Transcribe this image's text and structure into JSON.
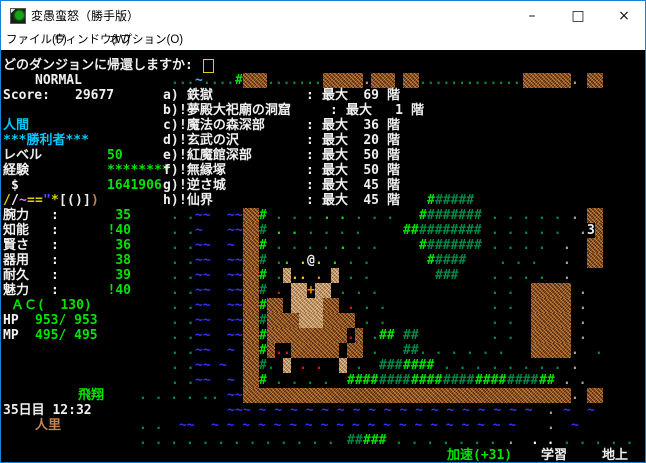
{
  "window": {
    "title": "変愚蛮怒（勝手版）",
    "controls": {
      "minimize": "–",
      "maximize": "□",
      "close": "×"
    },
    "border_color": "#1581d7"
  },
  "menu": {
    "items": [
      "ファイル(F)",
      "ウィンドウ(W)",
      "オプション(O)"
    ]
  },
  "palette": {
    "W": "#f0f0f0",
    "w": "#a0a0a0",
    "C": "#00c8ff",
    "G": "#00e400",
    "g": "#008845",
    "Y": "#ddd000",
    "O": "#ff8c00",
    "R": "#e01010",
    "B": "#3333f5",
    "L": "#3fb3f5",
    "M": "#f070f0",
    "U": "#c8824b",
    "b": "#5050ff"
  },
  "game": {
    "prompt": {
      "text": "どのダンジョンに帰還しますか:"
    },
    "mode": "NORMAL",
    "score_label": "Score:",
    "score": "29677"
  },
  "player": {
    "race": "人間",
    "title_str": "***勝利者***",
    "level_label": "レベル",
    "level": "50",
    "exp_label": "経験",
    "exp": "********",
    "gold_symbol": "$",
    "gold": "1641906",
    "equip": [
      [
        "/",
        "Y"
      ],
      [
        "/",
        "W"
      ],
      [
        "~",
        "M"
      ],
      [
        "=",
        "Y"
      ],
      [
        "=",
        "Y"
      ],
      [
        "\"",
        "b"
      ],
      [
        "*",
        "Y"
      ],
      [
        "[",
        "W"
      ],
      [
        "(",
        "W"
      ],
      [
        ")",
        "W"
      ],
      [
        "]",
        "W"
      ],
      [
        ")",
        "U"
      ]
    ],
    "stats": [
      {
        "label": "腕力",
        "value": "35"
      },
      {
        "label": "知能",
        "value": "!40"
      },
      {
        "label": "賢さ",
        "value": "36"
      },
      {
        "label": "器用",
        "value": "38"
      },
      {
        "label": "耐久",
        "value": "39"
      },
      {
        "label": "魅力",
        "value": "!40"
      }
    ],
    "ac": "ＡＣ(  130)",
    "hp_label": "HP",
    "hp": "953/ 953",
    "mp_label": "MP",
    "mp": "495/ 495",
    "flight": "飛翔",
    "datetime": "35日目 12:32",
    "location": "人里"
  },
  "dungeons": {
    "items": [
      {
        "key": "a)",
        "name": " 鉄獄",
        "max_label": "最大",
        "value": "69",
        "unit": "階",
        "wide": false
      },
      {
        "key": "b)",
        "name": "!夢殿大祀廟の洞窟",
        "max_label": "最大",
        "value": "1",
        "unit": "階",
        "wide": true
      },
      {
        "key": "c)",
        "name": "!魔法の森深部",
        "max_label": "最大",
        "value": "36",
        "unit": "階",
        "wide": false
      },
      {
        "key": "d)",
        "name": "!玄武の沢",
        "max_label": "最大",
        "value": "20",
        "unit": "階",
        "wide": false
      },
      {
        "key": "e)",
        "name": "!紅魔館深部",
        "max_label": "最大",
        "value": "50",
        "unit": "階",
        "wide": false
      },
      {
        "key": "f)",
        "name": "!無縁塚",
        "max_label": "最大",
        "value": "50",
        "unit": "階",
        "wide": false
      },
      {
        "key": "g)",
        "name": "!逆さ城",
        "max_label": "最大",
        "value": "45",
        "unit": "階",
        "wide": false
      },
      {
        "key": "h)",
        "name": "!仙界",
        "max_label": "最大",
        "value": "45",
        "unit": "階",
        "wide": false
      }
    ]
  },
  "statusbar": {
    "speed": "加速(+31)",
    "learning": "学習",
    "floor": "地上"
  },
  "map": {
    "segs": [
      [
        1,
        21,
        "...",
        "g"
      ],
      [
        1,
        24,
        "~",
        "L"
      ],
      [
        1,
        25,
        "....",
        "g"
      ],
      [
        1,
        29,
        "#",
        "G"
      ],
      [
        1,
        33,
        ".......",
        "g"
      ],
      [
        1,
        45,
        ".",
        "w"
      ],
      [
        1,
        52,
        ".............",
        "g"
      ],
      [
        1,
        71,
        ". ",
        "w"
      ],
      [
        9,
        53,
        "#",
        "G"
      ],
      [
        9,
        54,
        "#####",
        "g"
      ],
      [
        10,
        21,
        ". .",
        "g"
      ],
      [
        10,
        24,
        "~~",
        "B"
      ],
      [
        10,
        28,
        "~~",
        "B"
      ],
      [
        10,
        32,
        "#",
        "G"
      ],
      [
        10,
        34,
        ". . .",
        "g"
      ],
      [
        10,
        40,
        ". .",
        "G"
      ],
      [
        10,
        44,
        ". . . ",
        "g"
      ],
      [
        10,
        52,
        "#",
        "G"
      ],
      [
        10,
        53,
        "#######",
        "g"
      ],
      [
        10,
        61,
        ". . . . .",
        "g"
      ],
      [
        10,
        71,
        ".",
        "w"
      ],
      [
        11,
        21,
        ". .",
        "g"
      ],
      [
        11,
        24,
        "~",
        "B"
      ],
      [
        11,
        28,
        "~~",
        "B"
      ],
      [
        11,
        32,
        "#",
        "g"
      ],
      [
        11,
        34,
        ". .",
        "G"
      ],
      [
        11,
        38,
        ". . . .",
        "g"
      ],
      [
        11,
        50,
        "##",
        "G"
      ],
      [
        11,
        52,
        "########",
        "g"
      ],
      [
        11,
        61,
        ". . . . .",
        "g"
      ],
      [
        11,
        72,
        ".",
        "w"
      ],
      [
        11,
        73,
        "3",
        "W"
      ],
      [
        12,
        21,
        ". .",
        "g"
      ],
      [
        12,
        24,
        "~~",
        "B"
      ],
      [
        12,
        28,
        "~",
        "B"
      ],
      [
        12,
        32,
        "#",
        "G"
      ],
      [
        12,
        34,
        ". . . .",
        "g"
      ],
      [
        12,
        42,
        ".",
        "G"
      ],
      [
        12,
        44,
        ". .",
        "g"
      ],
      [
        12,
        52,
        "#",
        "G"
      ],
      [
        12,
        53,
        "#######",
        "g"
      ],
      [
        12,
        61,
        ". . . .",
        "g"
      ],
      [
        12,
        70,
        ". ",
        "w"
      ],
      [
        13,
        21,
        ". .",
        "g"
      ],
      [
        13,
        24,
        "~~",
        "B"
      ],
      [
        13,
        28,
        "~~",
        "B"
      ],
      [
        13,
        32,
        "#",
        "g"
      ],
      [
        13,
        34,
        ".",
        "g"
      ],
      [
        13,
        35,
        ".",
        "G"
      ],
      [
        13,
        37,
        ".",
        "Y"
      ],
      [
        13,
        38,
        "@",
        "W"
      ],
      [
        13,
        39,
        ".",
        "Y"
      ],
      [
        13,
        41,
        ".",
        "G"
      ],
      [
        13,
        43,
        ". .",
        "g"
      ],
      [
        13,
        53,
        "#",
        "G"
      ],
      [
        13,
        54,
        "####",
        "g"
      ],
      [
        13,
        62,
        ". . .",
        "g"
      ],
      [
        13,
        70,
        ".",
        "w"
      ],
      [
        14,
        21,
        ". .",
        "g"
      ],
      [
        14,
        24,
        "~~",
        "B"
      ],
      [
        14,
        28,
        "~~",
        "B"
      ],
      [
        14,
        32,
        "#",
        "G"
      ],
      [
        14,
        34,
        ".",
        "g"
      ],
      [
        14,
        36,
        ".",
        "Y"
      ],
      [
        14,
        37,
        ".",
        "Y"
      ],
      [
        14,
        39,
        ".",
        "O"
      ],
      [
        14,
        43,
        ". .",
        "g"
      ],
      [
        14,
        54,
        "###",
        "g"
      ],
      [
        14,
        61,
        ". . . .",
        "g"
      ],
      [
        14,
        70,
        ". ",
        "w"
      ],
      [
        15,
        21,
        ". .",
        "g"
      ],
      [
        15,
        24,
        "~~",
        "B"
      ],
      [
        15,
        28,
        "~~",
        "B"
      ],
      [
        15,
        32,
        "#",
        "g"
      ],
      [
        15,
        34,
        ".",
        "R"
      ],
      [
        15,
        38,
        "+",
        "O"
      ],
      [
        15,
        42,
        ".",
        "g"
      ],
      [
        15,
        44,
        ". .",
        "g"
      ],
      [
        15,
        61,
        ". .",
        "g"
      ],
      [
        15,
        72,
        ".",
        "w"
      ],
      [
        16,
        21,
        ". .",
        "g"
      ],
      [
        16,
        24,
        "~~",
        "B"
      ],
      [
        16,
        28,
        "~~",
        "B"
      ],
      [
        16,
        32,
        "#",
        "G"
      ],
      [
        16,
        43,
        ".",
        "R"
      ],
      [
        16,
        45,
        ". .",
        "g"
      ],
      [
        16,
        61,
        ". .",
        "g"
      ],
      [
        16,
        72,
        ".",
        "w"
      ],
      [
        17,
        21,
        ". .",
        "g"
      ],
      [
        17,
        24,
        "~~",
        "B"
      ],
      [
        17,
        28,
        "~~",
        "B"
      ],
      [
        17,
        32,
        "#",
        "g"
      ],
      [
        17,
        45,
        ". .",
        "g"
      ],
      [
        17,
        61,
        ". .",
        "g"
      ],
      [
        17,
        72,
        ".",
        "w"
      ],
      [
        18,
        21,
        ". .",
        "g"
      ],
      [
        18,
        24,
        "~~",
        "B"
      ],
      [
        18,
        28,
        "~~",
        "B"
      ],
      [
        18,
        32,
        "#",
        "G"
      ],
      [
        18,
        43,
        ".",
        "R"
      ],
      [
        18,
        46,
        ".",
        "g"
      ],
      [
        18,
        47,
        "##",
        "G"
      ],
      [
        18,
        50,
        "##",
        "g"
      ],
      [
        18,
        61,
        ". .",
        "g"
      ],
      [
        18,
        72,
        ".",
        "w"
      ],
      [
        19,
        21,
        ". .",
        "g"
      ],
      [
        19,
        24,
        "~~",
        "B"
      ],
      [
        19,
        28,
        "~",
        "B"
      ],
      [
        19,
        32,
        "#",
        "G"
      ],
      [
        19,
        34,
        ".",
        "R"
      ],
      [
        19,
        35,
        ".",
        "R"
      ],
      [
        19,
        46,
        ". ",
        "g"
      ],
      [
        19,
        50,
        "##",
        "g"
      ],
      [
        19,
        52,
        ". . . . . .",
        "g"
      ],
      [
        19,
        71,
        ". ",
        "w"
      ],
      [
        19,
        74,
        ". ",
        "g"
      ],
      [
        20,
        21,
        ". .",
        "g"
      ],
      [
        20,
        24,
        "~~",
        "B"
      ],
      [
        20,
        27,
        "~",
        "B"
      ],
      [
        20,
        32,
        "#",
        "g"
      ],
      [
        20,
        33,
        ".",
        "g"
      ],
      [
        20,
        37,
        ".",
        "R"
      ],
      [
        20,
        39,
        ".",
        "R"
      ],
      [
        20,
        44,
        ". ",
        "g"
      ],
      [
        20,
        47,
        "###",
        "g"
      ],
      [
        20,
        50,
        "####",
        "G"
      ],
      [
        20,
        55,
        ". . .",
        "g"
      ],
      [
        20,
        61,
        ". . . . .",
        "g"
      ],
      [
        20,
        71,
        ". ",
        "w"
      ],
      [
        21,
        21,
        ". .",
        "g"
      ],
      [
        21,
        24,
        "~~",
        "B"
      ],
      [
        21,
        28,
        "~",
        "B"
      ],
      [
        21,
        32,
        "#",
        "G"
      ],
      [
        21,
        34,
        ". . . .",
        "g"
      ],
      [
        21,
        43,
        "####",
        "G"
      ],
      [
        21,
        47,
        "####",
        "g"
      ],
      [
        21,
        51,
        "####",
        "G"
      ],
      [
        21,
        55,
        "####",
        "g"
      ],
      [
        21,
        59,
        "####",
        "G"
      ],
      [
        21,
        63,
        "####",
        "g"
      ],
      [
        21,
        67,
        "##",
        "G"
      ],
      [
        21,
        70,
        ". .",
        "w"
      ],
      [
        22,
        17,
        ". . . . .",
        "g"
      ],
      [
        22,
        26,
        ". ",
        "g"
      ],
      [
        22,
        28,
        "~~",
        "B"
      ],
      [
        22,
        71,
        ". ",
        "w"
      ],
      [
        23,
        28,
        "~~",
        "B"
      ],
      [
        23,
        30,
        "~ ~ ~ ~ ~ ~ ~ ~ ~ ~ ~ ~ ~ ~ ~ ~ ~ ~ ~",
        "B"
      ],
      [
        23,
        68,
        ".",
        "w"
      ],
      [
        23,
        70,
        "~",
        "B"
      ],
      [
        23,
        73,
        "~",
        "B"
      ],
      [
        24,
        17,
        ". .",
        "g"
      ],
      [
        24,
        22,
        "~~",
        "B"
      ],
      [
        24,
        26,
        "~ ~ ~ ~ ~ ~ ~ ~ ~ ~ ~ ~ ~ ~ ~ ~ ~ ~ ~ ~",
        "B"
      ],
      [
        24,
        68,
        ".",
        "w"
      ],
      [
        24,
        71,
        "~",
        "B"
      ],
      [
        25,
        17,
        ". . . . . . . . . . . . .",
        "g"
      ],
      [
        25,
        43,
        "##",
        "g"
      ],
      [
        25,
        45,
        "###",
        "G"
      ],
      [
        25,
        49,
        ". . . . . . .",
        "g"
      ],
      [
        25,
        63,
        ". ",
        "w"
      ],
      [
        25,
        66,
        ". .",
        "W"
      ],
      [
        25,
        70,
        ". . . . .",
        "g"
      ]
    ],
    "walls": [
      [
        1,
        30,
        3,
        "w"
      ],
      [
        1,
        40,
        5,
        "w"
      ],
      [
        1,
        46,
        3,
        "w"
      ],
      [
        1,
        50,
        2,
        "w"
      ],
      [
        1,
        65,
        6,
        "w"
      ],
      [
        1,
        73,
        2,
        "w"
      ],
      [
        10,
        30,
        2,
        "w"
      ],
      [
        10,
        73,
        2,
        "w"
      ],
      [
        11,
        30,
        2,
        "w"
      ],
      [
        11,
        74,
        1,
        "w"
      ],
      [
        12,
        30,
        2,
        "w"
      ],
      [
        12,
        73,
        2,
        "w"
      ],
      [
        13,
        30,
        2,
        "w"
      ],
      [
        13,
        73,
        2,
        "w"
      ],
      [
        14,
        30,
        2,
        "w"
      ],
      [
        14,
        35,
        1,
        "t"
      ],
      [
        14,
        41,
        1,
        "t"
      ],
      [
        15,
        30,
        2,
        "w"
      ],
      [
        15,
        36,
        2,
        "t"
      ],
      [
        15,
        39,
        2,
        "t"
      ],
      [
        15,
        66,
        5,
        "w"
      ],
      [
        16,
        30,
        2,
        "w"
      ],
      [
        16,
        33,
        2,
        "w"
      ],
      [
        16,
        36,
        4,
        "t"
      ],
      [
        16,
        40,
        2,
        "w"
      ],
      [
        16,
        66,
        5,
        "w"
      ],
      [
        17,
        30,
        2,
        "w"
      ],
      [
        17,
        33,
        4,
        "w"
      ],
      [
        17,
        37,
        3,
        "t"
      ],
      [
        17,
        40,
        4,
        "w"
      ],
      [
        17,
        66,
        5,
        "w"
      ],
      [
        18,
        30,
        2,
        "w"
      ],
      [
        18,
        33,
        10,
        "w"
      ],
      [
        18,
        44,
        1,
        "w"
      ],
      [
        18,
        66,
        5,
        "w"
      ],
      [
        19,
        30,
        2,
        "w"
      ],
      [
        19,
        33,
        1,
        "w"
      ],
      [
        19,
        36,
        6,
        "w"
      ],
      [
        19,
        43,
        2,
        "w"
      ],
      [
        19,
        66,
        5,
        "w"
      ],
      [
        20,
        30,
        2,
        "w"
      ],
      [
        20,
        35,
        1,
        "t"
      ],
      [
        20,
        42,
        1,
        "t"
      ],
      [
        21,
        30,
        2,
        "w"
      ],
      [
        22,
        30,
        41,
        "w"
      ],
      [
        22,
        73,
        2,
        "w"
      ]
    ]
  }
}
